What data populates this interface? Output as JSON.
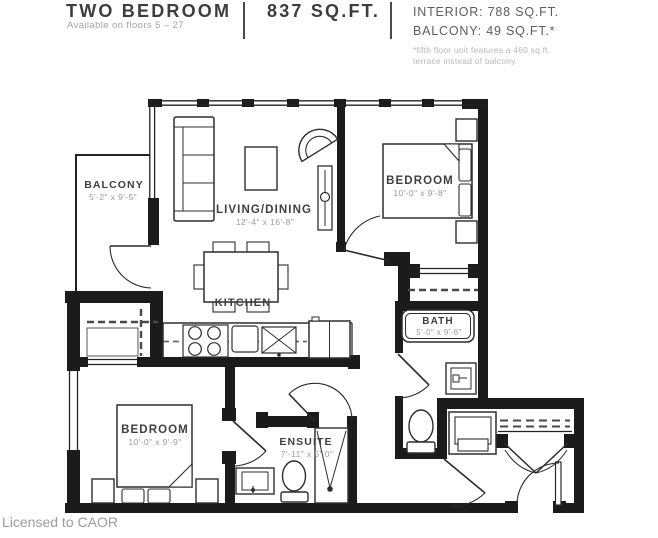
{
  "header": {
    "title": "TWO BEDROOM",
    "availability": "Available on floors 5 – 27",
    "total_area": "837 SQ.FT.",
    "interior_area": "INTERIOR: 788 SQ.FT.",
    "balcony_area": "BALCONY: 49 SQ.FT.*",
    "footnote_line1": "*fifth floor unit features a 460 sq.ft.",
    "footnote_line2": "terrace instead of balcony."
  },
  "rooms": {
    "balcony": {
      "name": "BALCONY",
      "dims": "5'-2\" x 9'-5\""
    },
    "living_dining": {
      "name": "LIVING/DINING",
      "dims": "12'-4\" x 16'-8\""
    },
    "bedroom_primary": {
      "name": "BEDROOM",
      "dims": "10'-0\" x 9'-8\""
    },
    "kitchen": {
      "name": "KITCHEN"
    },
    "bath": {
      "name": "BATH",
      "dims": "5'-0\" x 9'-6\""
    },
    "bedroom_second": {
      "name": "BEDROOM",
      "dims": "10'-0\" x 9'-9\""
    },
    "ensuite": {
      "name": "ENSUITE",
      "dims": "7'-11\" x 5'-0\""
    }
  },
  "footer": {
    "license": "Licensed to CAOR"
  },
  "colors": {
    "wall": "#1b1b1b",
    "line": "#2e2e2e",
    "room_name": "#3f3f3f",
    "dims": "#9a9a9a",
    "dash": "#4a4a4a"
  }
}
